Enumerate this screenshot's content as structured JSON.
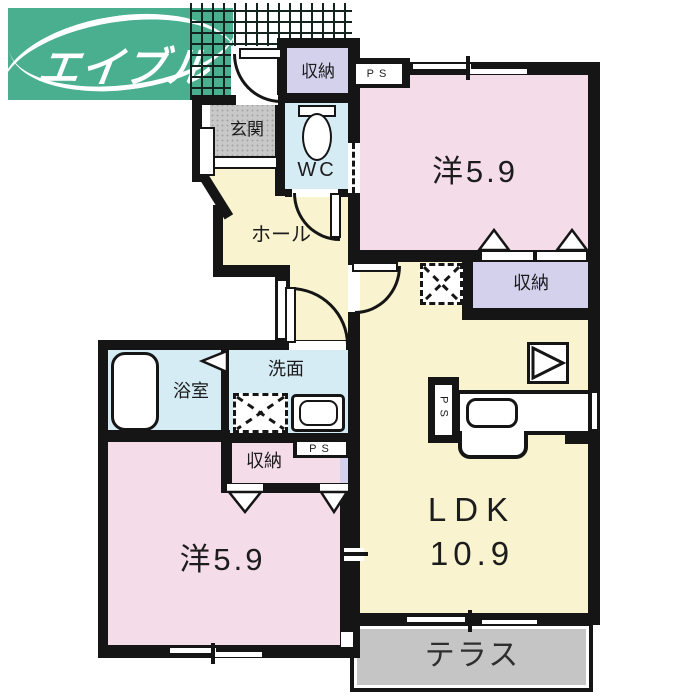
{
  "logo": {
    "text": "エイブル"
  },
  "rooms": {
    "bedroom1": {
      "label": "洋5.9"
    },
    "bedroom2": {
      "label": "洋5.9"
    },
    "ldk": {
      "name": "LDK",
      "size": "10.9"
    },
    "hall": {
      "label": "ホール"
    },
    "entrance": {
      "label": "玄関"
    },
    "wc": {
      "label": "WC"
    },
    "bathroom": {
      "label": "浴室"
    },
    "washroom": {
      "label": "洗面"
    },
    "terrace": {
      "label": "テラス"
    },
    "storage": {
      "label": "収納"
    },
    "pipe_space": {
      "label": "PS"
    }
  },
  "colors": {
    "logo_green": "#49af8f",
    "room_pink": "#f4dce9",
    "room_yellow": "#f9f4cf",
    "storage_lavender": "#d3d1ec",
    "wet_area_blue": "#d6ecf5",
    "entrance_gray": "#c8c8c8",
    "terrace_gray": "#c5c5c5",
    "wall_black": "#151515"
  }
}
